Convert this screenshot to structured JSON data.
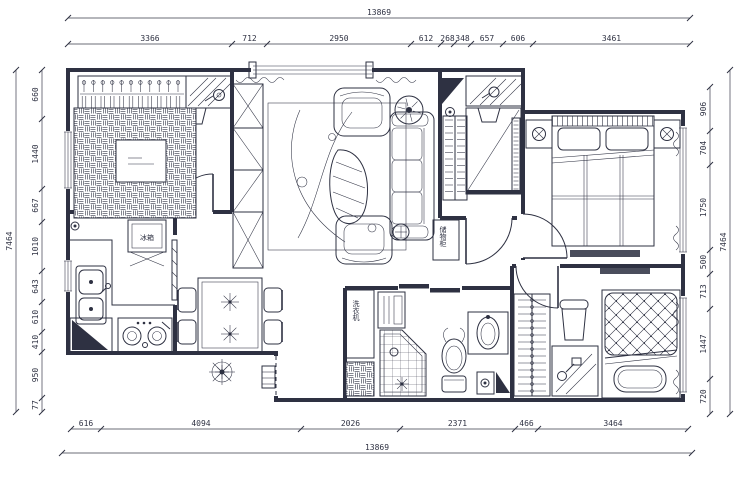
{
  "dimensions": {
    "top": {
      "total": "13869",
      "segments": [
        "3366",
        "712",
        "2950",
        "612",
        "268",
        "348",
        "657",
        "606",
        "3461"
      ]
    },
    "bottom": {
      "total": "13869",
      "segments": [
        "616",
        "4094",
        "2026",
        "2371",
        "466",
        "3464"
      ]
    },
    "left": {
      "total": "7464",
      "segments": [
        "660",
        "1440",
        "667",
        "1010",
        "643",
        "610",
        "410",
        "950",
        "77"
      ]
    },
    "right": {
      "total": "7464",
      "segments": [
        "906",
        "704",
        "1750",
        "500",
        "713",
        "1447",
        "720"
      ]
    }
  },
  "labels": {
    "fridge": "冰箱",
    "washer": "洗衣机",
    "hall_cabinet": "储物柜"
  },
  "colors": {
    "ink": "#2e3142",
    "paper": "#ffffff",
    "dark_fill": "#4a4d5c"
  }
}
